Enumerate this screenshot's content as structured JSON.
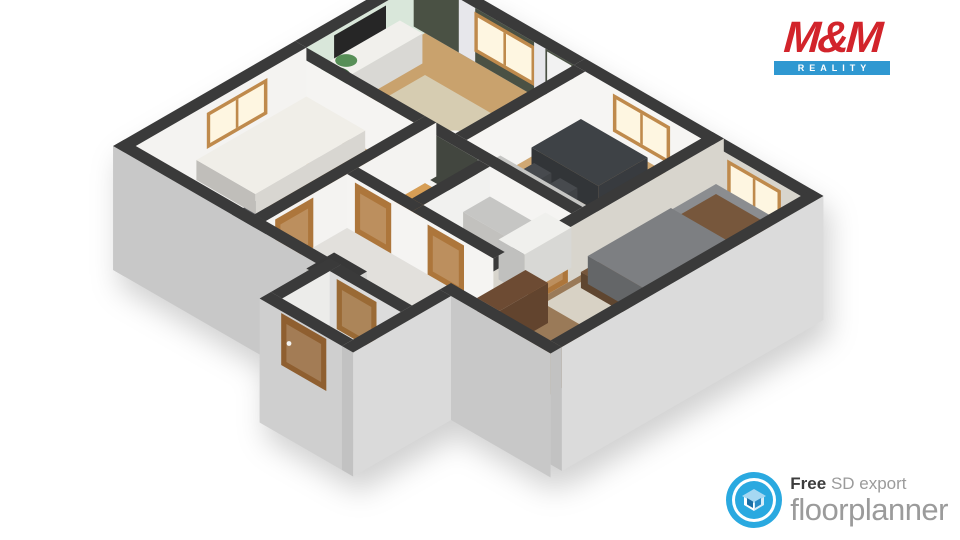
{
  "logos": {
    "mm_reality": {
      "title": "M&M",
      "subtitle": "REALITY",
      "red": "#d2242b",
      "blue": "#2f98d1"
    },
    "floorplanner": {
      "free_label": "Free",
      "tagline": "SD export",
      "brand": "floorplanner",
      "accent": "#2aa9e0",
      "icon": "floorplanner-house-icon"
    }
  },
  "scene": {
    "iso": {
      "ox": 425,
      "oy": 20,
      "wallH": 54,
      "ext": 70,
      "top": "#3a3a3a",
      "frame": "#bf8a4c",
      "glass": "#fef6e1"
    },
    "floors": [
      {
        "n": "floor-living-room",
        "r": [
          13,
          13,
          185,
          150
        ],
        "c": "#c9a26d"
      },
      {
        "n": "floor-kitchen-dining",
        "r": [
          198,
          13,
          332,
          150
        ],
        "c": "#d0a873"
      },
      {
        "n": "floor-bedroom-2",
        "r": [
          345,
          13,
          447,
          302
        ],
        "c": "#9a7a58"
      },
      {
        "n": "floor-bedroom-1",
        "r": [
          13,
          163,
          150,
          347
        ],
        "c": "#d0aa78"
      },
      {
        "n": "floor-wc",
        "r": [
          163,
          163,
          225,
          240
        ],
        "c": "#d79e55"
      },
      {
        "n": "floor-bathroom",
        "r": [
          238,
          163,
          332,
          240
        ],
        "c": "#e9e7e3"
      },
      {
        "n": "floor-hallway",
        "r": [
          163,
          253,
          332,
          347
        ],
        "c": "#e2e0dc"
      },
      {
        "n": "floor-entry-vestibule",
        "r": [
          250,
          347,
          332,
          415
        ],
        "c": "#e2e0dc"
      }
    ],
    "rugs": [
      {
        "n": "rug-living",
        "r": [
          55,
          55,
          175,
          140
        ],
        "c": "#d6ccb1"
      },
      {
        "n": "rug-living-round",
        "disc": [
          150,
          116,
          27,
          0
        ],
        "c": "#ded5c1"
      },
      {
        "n": "rug-bedroom-2",
        "r": [
          352,
          35,
          442,
          215
        ],
        "c": "#d8d2c5"
      },
      {
        "n": "rug-bedroom-1-dark",
        "r": [
          18,
          278,
          138,
          342
        ],
        "c": "#55575c"
      }
    ],
    "furniture": [
      {
        "n": "tv-sideboard",
        "r": [
          16,
          45,
          42,
          140
        ],
        "h": 30,
        "c": "#f1f0ec"
      },
      {
        "n": "fridge",
        "r": [
          202,
          18,
          226,
          50
        ],
        "h": 52,
        "c": "#f4f4f2"
      },
      {
        "n": "dining-table",
        "r": [
          215,
          35,
          292,
          92
        ],
        "h": 26,
        "c": "#3e4246"
      },
      {
        "n": "dining-chair-1",
        "r": [
          222,
          96,
          242,
          116
        ],
        "h": 16,
        "c": "#474a4e"
      },
      {
        "n": "dining-chair-2",
        "r": [
          252,
          96,
          272,
          116
        ],
        "h": 16,
        "c": "#474a4e"
      },
      {
        "n": "kitchen-counter",
        "r": [
          205,
          118,
          332,
          148
        ],
        "h": 26,
        "c": "#f0efeb",
        "tc": "#c6c6c4"
      },
      {
        "n": "kitchen-cabinet-dark",
        "r": [
          314,
          58,
          332,
          108
        ],
        "h": 32,
        "c": "#5b5e62"
      },
      {
        "n": "stove",
        "r": [
          210,
          315,
          248,
          347
        ],
        "h": 30,
        "c": "#edede9",
        "tc": "#383838"
      },
      {
        "n": "toilet-tank",
        "r": [
          196,
          166,
          218,
          177
        ],
        "h": 26,
        "c": "#f2f2f0"
      },
      {
        "n": "toilet",
        "r": [
          196,
          170,
          218,
          192
        ],
        "h": 14,
        "c": "#f8f8f6"
      },
      {
        "n": "bathroom-vanity",
        "r": [
          240,
          165,
          300,
          196
        ],
        "h": 26,
        "c": "#f2f1ed",
        "tc": "#c6c6c4"
      },
      {
        "n": "shower-unit",
        "r": [
          302,
          163,
          332,
          217
        ],
        "h": 40,
        "c": "#f0f0ed"
      },
      {
        "n": "single-bed",
        "r": [
          28,
          165,
          96,
          292
        ],
        "h": 20,
        "c": "#f0eee8"
      },
      {
        "n": "single-bed-headboard",
        "r": [
          28,
          165,
          96,
          180
        ],
        "h": 34,
        "c": "#daceb7"
      },
      {
        "n": "single-bed-pillow",
        "r": [
          36,
          184,
          88,
          210
        ],
        "h": 26,
        "c": "#fbfbf9"
      },
      {
        "n": "double-bed-frame",
        "r": [
          358,
          22,
          434,
          178
        ],
        "h": 16,
        "c": "#77573c"
      },
      {
        "n": "double-bed-mattress",
        "r": [
          358,
          22,
          434,
          168
        ],
        "h": 26,
        "c": "#8b8d90"
      },
      {
        "n": "double-bed-blanket",
        "r": [
          358,
          74,
          434,
          170
        ],
        "h": 28,
        "c": "#7d7f82"
      },
      {
        "n": "bed-pillow-1",
        "r": [
          364,
          28,
          396,
          56
        ],
        "h": 30,
        "c": "#d7d7d9"
      },
      {
        "n": "bed-pillow-2",
        "r": [
          398,
          28,
          430,
          56
        ],
        "h": 30,
        "c": "#d7d7d9"
      },
      {
        "n": "dresser",
        "r": [
          348,
          232,
          374,
          288
        ],
        "h": 40,
        "c": "#6d4b33"
      }
    ],
    "discs": [
      {
        "n": "plant-living",
        "d": [
          30,
          136,
          15,
          26
        ],
        "c": "#3c6b3c"
      },
      {
        "n": "plant-living-top",
        "d": [
          37,
          128,
          9,
          42
        ],
        "c": "#578f57"
      },
      {
        "n": "coffee-table-round",
        "d": [
          150,
          116,
          12,
          14
        ],
        "c": "#f3f2ee"
      },
      {
        "n": "toilet-seat",
        "d": [
          207,
          182,
          9,
          16
        ],
        "c": "#ffffff"
      },
      {
        "n": "plant-bedroom-2",
        "d": [
          354,
          296,
          9,
          20
        ],
        "c": "#4c7a45"
      }
    ],
    "walls": [
      {
        "n": "wall-ext-top-left-living",
        "r": [
          0,
          0,
          13,
          150
        ],
        "dr": "#d9e7da",
        "items": [
          {
            "n": "tv-screen",
            "t": "plain",
            "f": 58,
            "to": 118,
            "z": [
              24,
              50
            ],
            "c": "#262626"
          }
        ]
      },
      {
        "n": "wall-ext-top-left-bedroom1",
        "r": [
          0,
          150,
          13,
          360
        ],
        "dr": "#f4f3f1",
        "ext": true,
        "cap": true,
        "items": [
          {
            "n": "window-bedroom-1",
            "t": "window",
            "f": 195,
            "to": 265,
            "z": [
              10,
              46
            ]
          }
        ]
      },
      {
        "n": "wall-ext-top-right-living",
        "r": [
          0,
          0,
          185,
          13
        ],
        "dl": "#4a5144",
        "items": [
          {
            "n": "curtain-left",
            "t": "plain",
            "f": 52,
            "to": 71,
            "z": [
              0,
              54
            ],
            "c": "#e7e7eb"
          },
          {
            "n": "window-living",
            "t": "window",
            "f": 70,
            "to": 140,
            "z": [
              10,
              50
            ]
          },
          {
            "n": "curtain-right",
            "t": "plain",
            "f": 139,
            "to": 152,
            "z": [
              0,
              54
            ],
            "c": "#e7e7eb"
          },
          {
            "n": "balcony-door-panel",
            "t": "plain",
            "f": 154,
            "to": 182,
            "z": [
              0,
              52
            ],
            "c": "#f2f2f2"
          }
        ]
      },
      {
        "n": "wall-ext-top-right-kitchen",
        "r": [
          185,
          0,
          345,
          13
        ],
        "dl": "#f6f5f3",
        "items": [
          {
            "n": "window-kitchen",
            "t": "window",
            "f": 230,
            "to": 296,
            "z": [
              10,
              48
            ]
          }
        ]
      },
      {
        "n": "wall-ext-top-right-bedroom2",
        "r": [
          345,
          0,
          460,
          13
        ],
        "dl": "#d8d5cd",
        "items": [
          {
            "n": "window-bedroom-2",
            "t": "window",
            "f": 362,
            "to": 424,
            "z": [
              10,
              48
            ]
          }
        ]
      },
      {
        "n": "wall-living-bedroom1",
        "r": [
          13,
          150,
          150,
          163
        ],
        "dl": "#f5f4f2"
      },
      {
        "n": "wall-living-kitchen",
        "r": [
          185,
          13,
          198,
          150
        ],
        "dr": "#f6f5f3"
      },
      {
        "n": "wall-kitchen-bathroom",
        "r": [
          163,
          150,
          332,
          163
        ],
        "dl": "#f5f4f2",
        "items": [
          {
            "n": "wc-dark-accent-wall",
            "t": "plain",
            "f": 167,
            "to": 224,
            "z": [
              6,
              54
            ],
            "c": "#42463f"
          }
        ]
      },
      {
        "n": "wall-bedroom1-hall",
        "r": [
          150,
          150,
          163,
          347
        ],
        "dr": "#f4f3f1",
        "items": [
          {
            "n": "door-bedroom-1",
            "t": "door",
            "f": 292,
            "to": 336,
            "z": [
              0,
              50
            ],
            "c": "#ad763b"
          }
        ]
      },
      {
        "n": "wall-bedroom2-left",
        "r": [
          332,
          0,
          345,
          302
        ],
        "dr": "#d8d5cd",
        "items": [
          {
            "n": "door-bedroom-2",
            "t": "door",
            "f": 180,
            "to": 226,
            "z": [
              0,
              50
            ],
            "c": "#ad763b"
          }
        ]
      },
      {
        "n": "wall-wc-bathroom",
        "r": [
          225,
          163,
          238,
          240
        ],
        "dr": "#f1f1ef"
      },
      {
        "n": "wall-wc-front",
        "r": [
          163,
          240,
          238,
          253
        ],
        "dl": "#f5f4f2",
        "items": [
          {
            "n": "door-wc",
            "t": "door",
            "f": 172,
            "to": 214,
            "z": [
              0,
              50
            ],
            "c": "#ad763b"
          }
        ]
      },
      {
        "n": "wall-bathroom-front",
        "r": [
          238,
          240,
          332,
          253
        ],
        "dl": "#f5f4f2",
        "items": [
          {
            "n": "door-bathroom",
            "t": "door",
            "f": 256,
            "to": 298,
            "z": [
              0,
              50
            ],
            "c": "#ad763b"
          }
        ]
      },
      {
        "n": "wall-ext-bottom-left",
        "r": [
          0,
          347,
          250,
          360
        ],
        "dl": "#c8c8c8",
        "ext": true
      },
      {
        "n": "wall-hall-vestibule",
        "r": [
          250,
          347,
          332,
          360
        ],
        "dl": "#dcdcdc",
        "items": [
          {
            "n": "door-hall-vestibule",
            "t": "door",
            "f": 258,
            "to": 304,
            "z": [
              0,
              50
            ],
            "c": "#9a6a35"
          }
        ]
      },
      {
        "n": "wall-ext-bedroom2-bottom",
        "r": [
          332,
          302,
          460,
          315
        ],
        "dl": "#c8c8c8",
        "ext": true
      },
      {
        "n": "wall-vestibule-left",
        "r": [
          237,
          347,
          250,
          415
        ],
        "dr": "#ececea"
      },
      {
        "n": "wall-ext-vestibule-front",
        "r": [
          237,
          415,
          332,
          428
        ],
        "dl": "#cfcfcf",
        "ext": true,
        "items": [
          {
            "n": "door-entry-main",
            "t": "door",
            "f": 262,
            "to": 314,
            "z": [
              0,
              52
            ],
            "c": "#8f5f30",
            "knob": true
          }
        ]
      },
      {
        "n": "wall-ext-step",
        "r": [
          332,
          315,
          345,
          428
        ],
        "dr": "#dadada",
        "ext": true,
        "cap": true
      },
      {
        "n": "wall-ext-right-end",
        "r": [
          447,
          0,
          460,
          302
        ],
        "dr": "#dbdbdb",
        "ext": true,
        "cap": true
      }
    ]
  }
}
